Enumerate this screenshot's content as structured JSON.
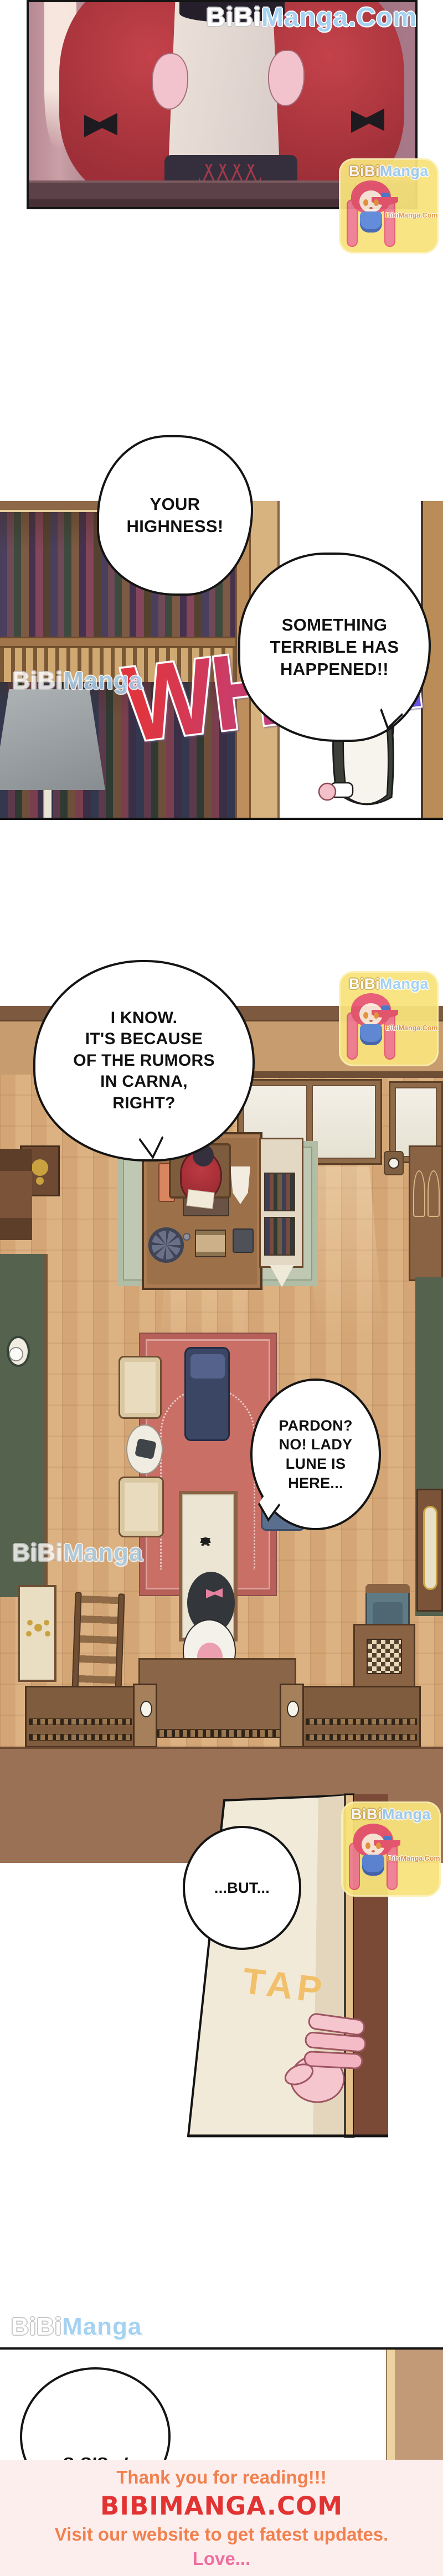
{
  "watermarks": {
    "bibi": "BiBi",
    "manga": "Manga",
    "manga_dot_com": "Manga.Com",
    "badge_site": "BibiManga.Com",
    "mascot": "chibi-girl-mascot"
  },
  "bubbles": {
    "your_highness": "YOUR\nHIGHNESS!",
    "something_terrible": "SOMETHING\nTERRIBLE HAS\nHAPPENED!!",
    "i_know": "I KNOW.\nIT'S BECAUSE\nOF THE RUMORS\nIN CARNA,\nRIGHT?",
    "pardon": "PARDON?\nNO! LADY\nLUNE IS\nHERE...",
    "but": "...BUT...",
    "s_sis": "S-SIS...!"
  },
  "sfx": {
    "wham": "WHAM",
    "tap": "TAP"
  },
  "footer": {
    "thanks": "Thank you for reading!!!",
    "site": "BIBIMANGA.COM",
    "visit": "Visit our website to get fatest updates.",
    "love": "Love..."
  },
  "colors": {
    "watermark_blue": "#a5d2f1",
    "badge_yellow": "#f8e37c",
    "badge_site_orange": "#e0953f",
    "wham_red": "#e0353f",
    "wham_purple": "#6b55e0",
    "tap_orange": "#f2c06a",
    "footer_bg": "#fdeeee",
    "footer_orange": "#f0814e",
    "footer_red": "#e23333",
    "footer_pink": "#ee6f9f"
  }
}
